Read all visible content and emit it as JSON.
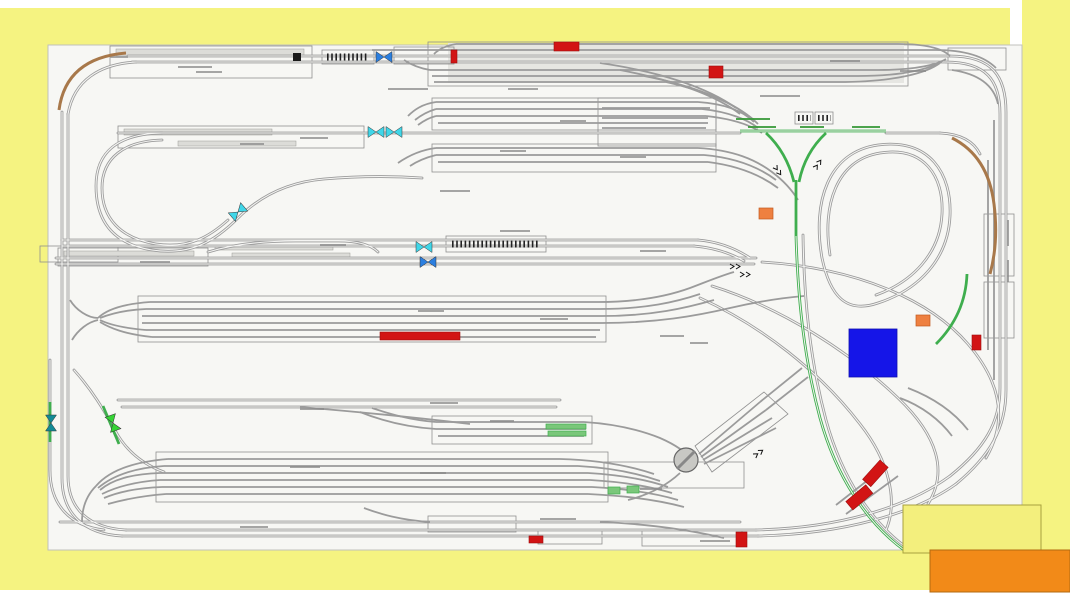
{
  "frame": {
    "color": "#f5f381",
    "page_bg": "#ffffff",
    "canvas_bg": "#f7f7f4",
    "canvas_border": "#c0c0bc"
  },
  "palette": {
    "track": "#9b9b9b",
    "rail_gap": "#f4f4f2",
    "outline": "#8f8f8f",
    "platform": "#dcdcd8",
    "yard_shade": "#e6e6e2",
    "barcode": "#222222",
    "green_track": "#3fae4e",
    "brown_track": "#a8784a",
    "smudge": "#8a8a8a",
    "smudge_green": "#3a9a3a"
  },
  "markers": {
    "bowties": [
      {
        "kind": "blue-crossing",
        "color": "#2b7fe0"
      },
      {
        "kind": "cyan-crossing",
        "color": "#40d6e8"
      },
      {
        "kind": "cyan-crossing",
        "color": "#40d6e8"
      },
      {
        "kind": "cyan-crossing",
        "color": "#40d6e8"
      },
      {
        "kind": "cyan-crossing",
        "color": "#40d6e8"
      },
      {
        "kind": "blue-crossing",
        "color": "#2b7fe0"
      },
      {
        "kind": "teal-crossing",
        "color": "#128a96"
      },
      {
        "kind": "green-crossing",
        "color": "#35d435"
      }
    ],
    "red_blocks": {
      "color": "#d21414",
      "border": "#9c0e0e",
      "count": 9
    },
    "orange_blocks": {
      "color": "#ee8040",
      "border": "#c05a20",
      "count": 2
    },
    "blue_square": {
      "color": "#1515e8",
      "border": "#0d0db0"
    },
    "green_blocks": {
      "color": "#7ac77a",
      "border": "#3fae4e",
      "count": 4
    },
    "black_block": {
      "color": "#1a1a1a"
    },
    "turntable": {
      "fill": "#c8c8c4",
      "stroke": "#666666",
      "bridge": "#888888"
    }
  },
  "legend": {
    "yellow_box": {
      "fill": "#f3ef7d",
      "border": "#a8a23f"
    },
    "orange_box": {
      "fill": "#f28a18",
      "border": "#b36a10"
    }
  }
}
